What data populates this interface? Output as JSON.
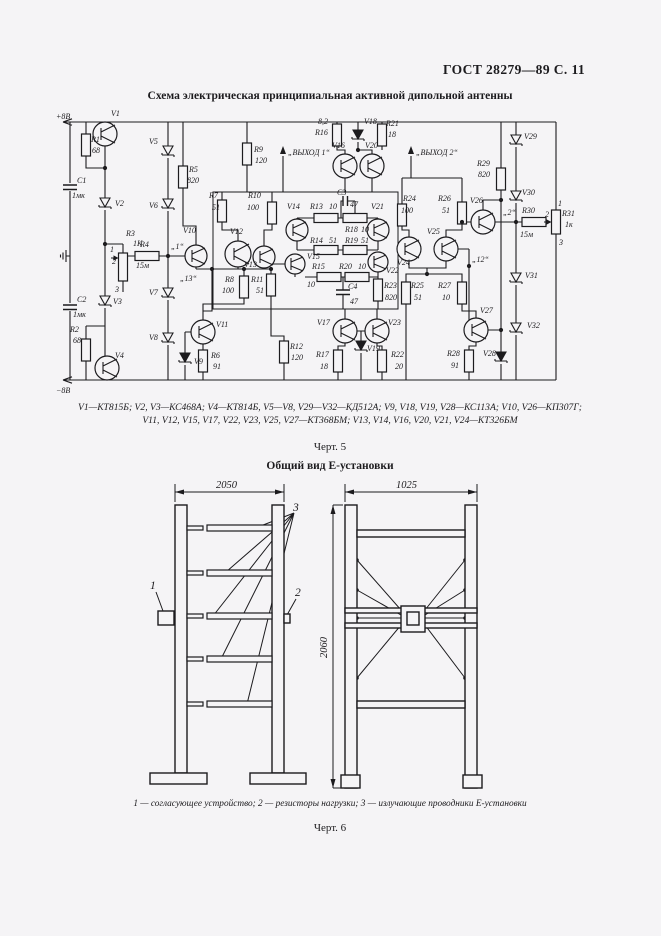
{
  "page": {
    "header": "ГОСТ 28279—89 С. 11",
    "fig5_title": "Схема электрическая принципиальная активной дипольной антенны",
    "components_line1": "V1—КТ815Б; V2, V3—КС468А; V4—КТ814Б, V5—V8, V29—V32—КД512А; V9, V18, V19, V28—КС113А; V10, V26—КП307Г;",
    "components_line2": "V11, V12, V15, V17, V22, V23, V25, V27—КТ368БМ; V13, V14, V16, V20, V21, V24—КТ326БМ",
    "fig5_caption": "Черт. 5",
    "fig6_title": "Общий вид Е-установки",
    "fig6_legend": "1 — согласующее устройство; 2 — резисторы нагрузки; 3 — излучающие проводники Е-установки",
    "fig6_caption": "Черт. 6"
  },
  "schematic": {
    "ink": "#1c1b1e",
    "labels": [
      {
        "x": 1,
        "y": 13,
        "t": "+8В"
      },
      {
        "x": 1,
        "y": 287,
        "t": "−8В"
      },
      {
        "x": 56,
        "y": 10,
        "t": "V1"
      },
      {
        "x": 36,
        "y": 36,
        "t": "R1"
      },
      {
        "x": 37,
        "y": 47,
        "t": "68"
      },
      {
        "x": 22,
        "y": 77,
        "t": "C1"
      },
      {
        "x": 17,
        "y": 92,
        "t": "1мк"
      },
      {
        "x": 60,
        "y": 100,
        "t": "V2"
      },
      {
        "x": 94,
        "y": 38,
        "t": "V5"
      },
      {
        "x": 94,
        "y": 102,
        "t": "V6"
      },
      {
        "x": 134,
        "y": 66,
        "t": "R5"
      },
      {
        "x": 132,
        "y": 77,
        "t": "820"
      },
      {
        "x": 71,
        "y": 130,
        "t": "R3"
      },
      {
        "x": 78,
        "y": 140,
        "t": "1К"
      },
      {
        "x": 55,
        "y": 146,
        "t": "1"
      },
      {
        "x": 57,
        "y": 158,
        "t": "2"
      },
      {
        "x": 60,
        "y": 186,
        "t": "3"
      },
      {
        "x": 85,
        "y": 141,
        "t": "R4"
      },
      {
        "x": 81,
        "y": 162,
        "t": "15м"
      },
      {
        "x": 116,
        "y": 143,
        "t": "„1“"
      },
      {
        "x": 128,
        "y": 127,
        "t": "V10"
      },
      {
        "x": 125,
        "y": 175,
        "t": "„13“"
      },
      {
        "x": 94,
        "y": 189,
        "t": "V7"
      },
      {
        "x": 94,
        "y": 234,
        "t": "V8"
      },
      {
        "x": 139,
        "y": 258,
        "t": "V9"
      },
      {
        "x": 22,
        "y": 196,
        "t": "C2"
      },
      {
        "x": 18,
        "y": 211,
        "t": "1мк"
      },
      {
        "x": 58,
        "y": 198,
        "t": "V3"
      },
      {
        "x": 15,
        "y": 226,
        "t": "R2"
      },
      {
        "x": 18,
        "y": 237,
        "t": "68"
      },
      {
        "x": 60,
        "y": 252,
        "t": "V4"
      },
      {
        "x": 161,
        "y": 221,
        "t": "V11"
      },
      {
        "x": 156,
        "y": 252,
        "t": "R6"
      },
      {
        "x": 158,
        "y": 263,
        "t": "91"
      },
      {
        "x": 235,
        "y": 243,
        "t": "R12"
      },
      {
        "x": 236,
        "y": 254,
        "t": "120"
      },
      {
        "x": 170,
        "y": 176,
        "t": "R8"
      },
      {
        "x": 167,
        "y": 187,
        "t": "100"
      },
      {
        "x": 196,
        "y": 176,
        "t": "R11"
      },
      {
        "x": 201,
        "y": 187,
        "t": "51"
      },
      {
        "x": 175,
        "y": 128,
        "t": "V12"
      },
      {
        "x": 189,
        "y": 161,
        "t": "V13"
      },
      {
        "x": 154,
        "y": 92,
        "t": "R7"
      },
      {
        "x": 157,
        "y": 104,
        "t": "51"
      },
      {
        "x": 199,
        "y": 46,
        "t": "R9"
      },
      {
        "x": 200,
        "y": 57,
        "t": "120"
      },
      {
        "x": 193,
        "y": 92,
        "t": "R10"
      },
      {
        "x": 192,
        "y": 104,
        "t": "100"
      },
      {
        "x": 263,
        "y": 18,
        "t": "8,2"
      },
      {
        "x": 260,
        "y": 29,
        "t": "R16"
      },
      {
        "x": 309,
        "y": 18,
        "t": "V18"
      },
      {
        "x": 331,
        "y": 20,
        "t": "R21"
      },
      {
        "x": 333,
        "y": 31,
        "t": "18"
      },
      {
        "x": 277,
        "y": 42,
        "t": "V16"
      },
      {
        "x": 310,
        "y": 42,
        "t": "V20"
      },
      {
        "x": 233,
        "y": 49,
        "t": "„ВЫХОД 1“"
      },
      {
        "x": 361,
        "y": 49,
        "t": "„ВЫХОД 2“"
      },
      {
        "x": 282,
        "y": 89,
        "t": "C3"
      },
      {
        "x": 295,
        "y": 101,
        "t": "47"
      },
      {
        "x": 255,
        "y": 103,
        "t": "R13"
      },
      {
        "x": 274,
        "y": 103,
        "t": "10"
      },
      {
        "x": 290,
        "y": 126,
        "t": "R18"
      },
      {
        "x": 306,
        "y": 126,
        "t": "10"
      },
      {
        "x": 255,
        "y": 137,
        "t": "R14"
      },
      {
        "x": 274,
        "y": 137,
        "t": "51"
      },
      {
        "x": 290,
        "y": 137,
        "t": "R19"
      },
      {
        "x": 306,
        "y": 137,
        "t": "51"
      },
      {
        "x": 232,
        "y": 103,
        "t": "V14"
      },
      {
        "x": 316,
        "y": 103,
        "t": "V21"
      },
      {
        "x": 252,
        "y": 153,
        "t": "V15"
      },
      {
        "x": 331,
        "y": 167,
        "t": "V22"
      },
      {
        "x": 257,
        "y": 163,
        "t": "R15"
      },
      {
        "x": 252,
        "y": 181,
        "t": "10"
      },
      {
        "x": 284,
        "y": 163,
        "t": "R20"
      },
      {
        "x": 303,
        "y": 163,
        "t": "10"
      },
      {
        "x": 293,
        "y": 183,
        "t": "C4"
      },
      {
        "x": 295,
        "y": 198,
        "t": "47"
      },
      {
        "x": 329,
        "y": 182,
        "t": "R23"
      },
      {
        "x": 330,
        "y": 194,
        "t": "820"
      },
      {
        "x": 262,
        "y": 219,
        "t": "V17"
      },
      {
        "x": 333,
        "y": 219,
        "t": "V23"
      },
      {
        "x": 312,
        "y": 245,
        "t": "V19"
      },
      {
        "x": 261,
        "y": 251,
        "t": "R17"
      },
      {
        "x": 265,
        "y": 263,
        "t": "18"
      },
      {
        "x": 336,
        "y": 251,
        "t": "R22"
      },
      {
        "x": 340,
        "y": 263,
        "t": "20"
      },
      {
        "x": 348,
        "y": 95,
        "t": "R24"
      },
      {
        "x": 346,
        "y": 107,
        "t": "100"
      },
      {
        "x": 383,
        "y": 95,
        "t": "R26"
      },
      {
        "x": 387,
        "y": 107,
        "t": "51"
      },
      {
        "x": 372,
        "y": 128,
        "t": "V25"
      },
      {
        "x": 342,
        "y": 159,
        "t": "V24"
      },
      {
        "x": 356,
        "y": 182,
        "t": "R25"
      },
      {
        "x": 359,
        "y": 194,
        "t": "51"
      },
      {
        "x": 383,
        "y": 182,
        "t": "R27"
      },
      {
        "x": 387,
        "y": 194,
        "t": "10"
      },
      {
        "x": 417,
        "y": 156,
        "t": "„12“"
      },
      {
        "x": 425,
        "y": 207,
        "t": "V27"
      },
      {
        "x": 392,
        "y": 250,
        "t": "R28"
      },
      {
        "x": 396,
        "y": 262,
        "t": "91"
      },
      {
        "x": 428,
        "y": 250,
        "t": "V28"
      },
      {
        "x": 415,
        "y": 97,
        "t": "V26"
      },
      {
        "x": 422,
        "y": 60,
        "t": "R29"
      },
      {
        "x": 423,
        "y": 71,
        "t": "820"
      },
      {
        "x": 448,
        "y": 109,
        "t": "„2“"
      },
      {
        "x": 467,
        "y": 107,
        "t": "R30"
      },
      {
        "x": 465,
        "y": 131,
        "t": "15м"
      },
      {
        "x": 490,
        "y": 111,
        "t": "2"
      },
      {
        "x": 507,
        "y": 110,
        "t": "R31"
      },
      {
        "x": 510,
        "y": 121,
        "t": "1к"
      },
      {
        "x": 503,
        "y": 100,
        "t": "1"
      },
      {
        "x": 504,
        "y": 139,
        "t": "3"
      },
      {
        "x": 469,
        "y": 33,
        "t": "V29"
      },
      {
        "x": 467,
        "y": 89,
        "t": "V30"
      },
      {
        "x": 470,
        "y": 172,
        "t": "V31"
      },
      {
        "x": 472,
        "y": 222,
        "t": "V32"
      }
    ],
    "resistors": [
      {
        "x": 31,
        "y": 39,
        "o": "v"
      },
      {
        "x": 31,
        "y": 244,
        "o": "v"
      },
      {
        "x": 92,
        "y": 150,
        "o": "h"
      },
      {
        "x": 128,
        "y": 71,
        "o": "v"
      },
      {
        "x": 148,
        "y": 255,
        "o": "v"
      },
      {
        "x": 167,
        "y": 105,
        "o": "v"
      },
      {
        "x": 189,
        "y": 181,
        "o": "v"
      },
      {
        "x": 192,
        "y": 48,
        "o": "v"
      },
      {
        "x": 217,
        "y": 107,
        "o": "v"
      },
      {
        "x": 216,
        "y": 179,
        "o": "v"
      },
      {
        "x": 229,
        "y": 246,
        "o": "v"
      },
      {
        "x": 271,
        "y": 112,
        "o": "h"
      },
      {
        "x": 271,
        "y": 144,
        "o": "h"
      },
      {
        "x": 274,
        "y": 171,
        "o": "h"
      },
      {
        "x": 282,
        "y": 29,
        "o": "v"
      },
      {
        "x": 283,
        "y": 255,
        "o": "v"
      },
      {
        "x": 300,
        "y": 112,
        "o": "h"
      },
      {
        "x": 300,
        "y": 144,
        "o": "h"
      },
      {
        "x": 302,
        "y": 171,
        "o": "h"
      },
      {
        "x": 327,
        "y": 29,
        "o": "v"
      },
      {
        "x": 327,
        "y": 255,
        "o": "v"
      },
      {
        "x": 323,
        "y": 184,
        "o": "v"
      },
      {
        "x": 347,
        "y": 109,
        "o": "v"
      },
      {
        "x": 351,
        "y": 187,
        "o": "v"
      },
      {
        "x": 407,
        "y": 107,
        "o": "v"
      },
      {
        "x": 407,
        "y": 187,
        "o": "v"
      },
      {
        "x": 414,
        "y": 255,
        "o": "v"
      },
      {
        "x": 446,
        "y": 73,
        "o": "v"
      },
      {
        "x": 479,
        "y": 116,
        "o": "h"
      }
    ],
    "transistors": [
      {
        "x": 50,
        "y": 28,
        "r": 12
      },
      {
        "x": 52,
        "y": 262,
        "r": 12
      },
      {
        "x": 141,
        "y": 150,
        "r": 11
      },
      {
        "x": 148,
        "y": 226,
        "r": 12
      },
      {
        "x": 183,
        "y": 148,
        "r": 13
      },
      {
        "x": 209,
        "y": 151,
        "r": 11
      },
      {
        "x": 242,
        "y": 124,
        "r": 11
      },
      {
        "x": 240,
        "y": 158,
        "r": 10
      },
      {
        "x": 290,
        "y": 60,
        "r": 12
      },
      {
        "x": 290,
        "y": 225,
        "r": 12
      },
      {
        "x": 317,
        "y": 60,
        "r": 12
      },
      {
        "x": 323,
        "y": 124,
        "r": 11
      },
      {
        "x": 323,
        "y": 156,
        "r": 10
      },
      {
        "x": 322,
        "y": 225,
        "r": 12
      },
      {
        "x": 354,
        "y": 143,
        "r": 12
      },
      {
        "x": 391,
        "y": 143,
        "r": 12
      },
      {
        "x": 428,
        "y": 116,
        "r": 12
      },
      {
        "x": 421,
        "y": 224,
        "r": 12
      }
    ],
    "diodes": [
      {
        "x": 50,
        "y": 92
      },
      {
        "x": 50,
        "y": 190
      },
      {
        "x": 113,
        "y": 40
      },
      {
        "x": 113,
        "y": 93
      },
      {
        "x": 113,
        "y": 182
      },
      {
        "x": 113,
        "y": 227
      },
      {
        "x": 130,
        "y": 247,
        "f": 1
      },
      {
        "x": 303,
        "y": 24,
        "f": 1
      },
      {
        "x": 306,
        "y": 235,
        "f": 1
      },
      {
        "x": 446,
        "y": 246,
        "f": 1
      },
      {
        "x": 461,
        "y": 29
      },
      {
        "x": 461,
        "y": 85
      },
      {
        "x": 461,
        "y": 167
      },
      {
        "x": 461,
        "y": 217
      }
    ],
    "caps": [
      {
        "x": 15,
        "y": 81,
        "o": "v"
      },
      {
        "x": 15,
        "y": 201,
        "o": "v"
      },
      {
        "x": 290,
        "y": 95,
        "o": "h"
      },
      {
        "x": 288,
        "y": 186,
        "o": "v"
      }
    ],
    "pots": [
      {
        "x": 68,
        "y1": 147,
        "y2": 175,
        "wy": 152
      },
      {
        "x": 501,
        "y1": 104,
        "y2": 128,
        "wy": 116
      }
    ],
    "dots": [
      [
        50,
        62
      ],
      [
        50,
        138
      ],
      [
        113,
        150
      ],
      [
        157,
        163
      ],
      [
        189,
        163
      ],
      [
        216,
        163
      ],
      [
        303,
        44
      ],
      [
        461,
        116
      ],
      [
        446,
        94
      ],
      [
        446,
        224
      ],
      [
        414,
        160
      ],
      [
        407,
        116
      ],
      [
        372,
        168
      ]
    ],
    "out_arrows": [
      {
        "x": 228,
        "y1": 86,
        "y2": 46
      },
      {
        "x": 356,
        "y1": 72,
        "y2": 46
      }
    ]
  },
  "figure6": {
    "dim_left": "2050",
    "dim_right": "1025",
    "dim_height": "2060",
    "callout1": "1",
    "callout2": "2",
    "callout3": "3"
  }
}
